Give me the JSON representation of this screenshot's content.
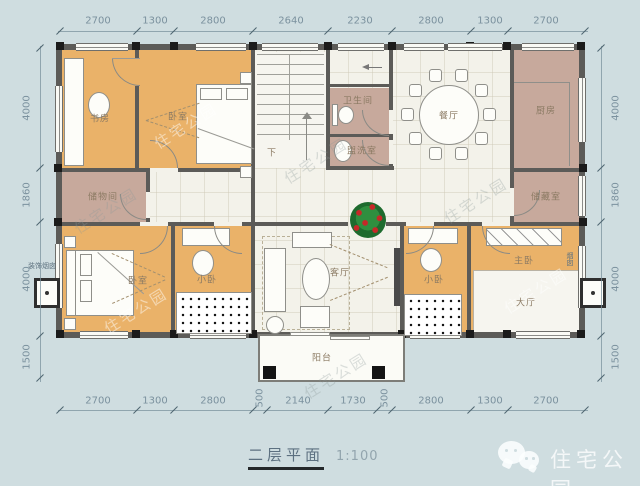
{
  "title": {
    "name": "二层平面",
    "scale": "1:100"
  },
  "brand": {
    "name": "住宅公园",
    "icon": "wechat-icon"
  },
  "watermark": {
    "text": "住宅公园"
  },
  "floor_plan": {
    "rooms": {
      "study": "书房",
      "bedroom_top": "卧室",
      "storage": "储物间",
      "bathroom": "卫生间",
      "washroom": "盥洗室",
      "dining": "餐厅",
      "kitchen": "厨房",
      "pantry": "储藏室",
      "bedroom_left": "卧室",
      "small_bedroom_left": "小卧",
      "living": "客厅",
      "small_bedroom_right": "小卧",
      "master_bedroom": "主卧",
      "hall": "大厅",
      "balcony": "阳台"
    },
    "annotations": {
      "stairs_down": "下",
      "left_chimney": "装饰烟囱",
      "right_chimney": "烟囱"
    },
    "dimensions": {
      "top": [
        "2700",
        "1300",
        "2800",
        "2640",
        "2230",
        "2800",
        "1300",
        "2700"
      ],
      "bottom": [
        "2700",
        "1300",
        "2800",
        "500",
        "2140",
        "1730",
        "500",
        "2800",
        "1300",
        "2700"
      ],
      "left": [
        "4000",
        "1860",
        "4000",
        "1500"
      ],
      "right": [
        "4000",
        "1860",
        "4000",
        "1500"
      ]
    },
    "colors": {
      "background": "#cfdde0",
      "room_orange": "#eab269",
      "room_mauve": "#c7a99c",
      "floor": "#f3f2ea",
      "wall": "#5c5b58"
    }
  }
}
